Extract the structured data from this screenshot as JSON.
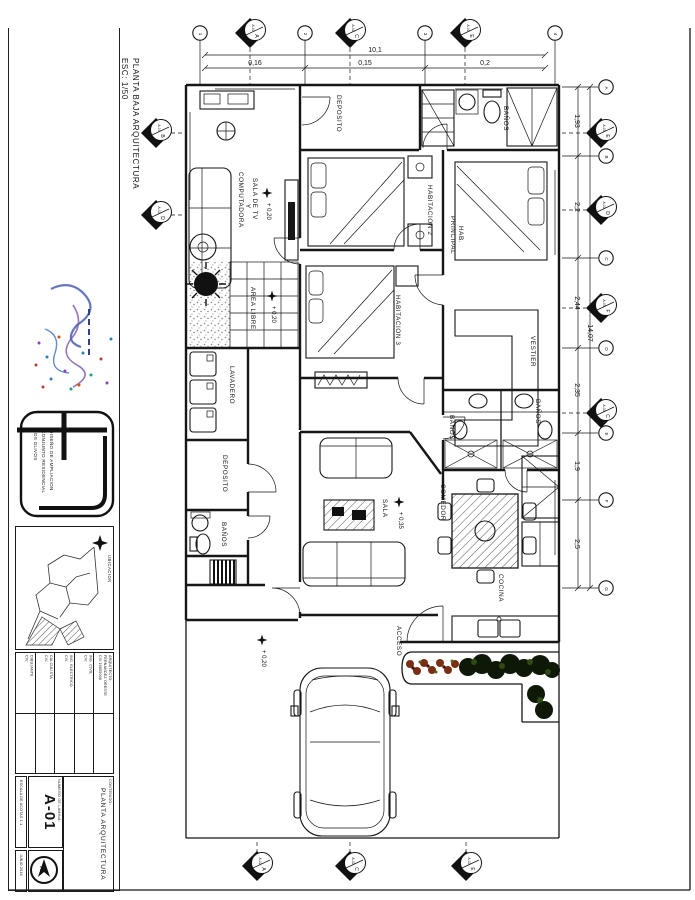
{
  "sheet": {
    "title_vertical": "PLANTA BAJA ARQUITECTURA",
    "scale_note": "ESC: 1/50"
  },
  "branding": {
    "firm_lines": [
      "DISEÑO DE AMPLIACION",
      "CONJUNTO RESIDENCIAL",
      "LOS OLIVOS"
    ]
  },
  "location": {
    "label": "UBICACION"
  },
  "signatures": [
    {
      "role": "DIBUJANTE",
      "name": "",
      "reg": "CIV."
    },
    {
      "role": "CALCULISTA",
      "name": "",
      "reg": "CIV."
    },
    {
      "role": "ING. ELECTRICO",
      "name": "",
      "reg": "CIV."
    },
    {
      "role": "ING. CIVIL",
      "name": "",
      "reg": "CIV."
    },
    {
      "role": "ARQUITECTO:",
      "name": "FERNANDEZ ORESTE",
      "reg": "CIV.19855006"
    }
  ],
  "titleblock": {
    "scale_strip": "ESCALA DE ACOTAS 1:1",
    "date_strip": "JUNIO 2016",
    "sheet_no_label": "NUMERO DE LAMINA:",
    "sheet_no": "A-01",
    "content_label": "CONTENIDO:",
    "content": "PLANTA ARQUITECTURA",
    "north_letter": "N"
  },
  "dims": {
    "top": {
      "overall": "10,1",
      "segments": [
        "0,16",
        "0,15",
        "0,2"
      ]
    },
    "right": {
      "overall": "14,07",
      "segments": [
        "1,93",
        "2,2",
        "2,44",
        "2,35",
        "1,9",
        "2,5"
      ]
    }
  },
  "grid": {
    "top_circles": [
      "1",
      "2",
      "3",
      "4"
    ],
    "right_circles": [
      "A",
      "B",
      "C",
      "D",
      "E",
      "F",
      "G"
    ]
  },
  "markers": {
    "top": [
      {
        "letter": "A",
        "sheet": "A-02"
      },
      {
        "letter": "C",
        "sheet": "A-02"
      },
      {
        "letter": "E",
        "sheet": "A-02"
      }
    ],
    "bottom": [
      {
        "letter": "A",
        "sheet": "A-02"
      },
      {
        "letter": "C",
        "sheet": "A-02"
      },
      {
        "letter": "E",
        "sheet": "A-02"
      }
    ],
    "left": [
      {
        "letter": "B",
        "sheet": "A-01"
      },
      {
        "letter": "D",
        "sheet": "A-01"
      }
    ],
    "right": [
      {
        "letter": "E",
        "sheet": "A-03"
      },
      {
        "letter": "D",
        "sheet": "A-01"
      },
      {
        "letter": "F",
        "sheet": "A-03"
      },
      {
        "letter": "C",
        "sheet": "A-03"
      }
    ]
  },
  "rooms": {
    "deposito_top": "DEPOSITO",
    "banos_top": "BAÑOS",
    "sala_tv_1": "SALA DE TV",
    "sala_tv_2": "Y",
    "sala_tv_3": "COMPUTADORA",
    "habitacion2": "HABITACION 2",
    "hab_principal_1": "HAB.",
    "hab_principal_2": "PRINCIPAL",
    "area_libre": "AREA LIBRE",
    "habitacion3": "HABITACION 3",
    "vestier": "VESTIER",
    "lavadero": "LAVADERO",
    "banos_c1": "BAÑOS",
    "banos_c2": "BAÑOS",
    "deposito_left": "DEPOSITO",
    "banos_left": "BAÑOS",
    "sala": "SALA",
    "comedor": "COMEDOR",
    "cocina": "COCINA",
    "acceso": "ACCESO"
  },
  "levels": {
    "sala_tv": "+ 0,20",
    "area_libre": "+ 0,20",
    "sala": "+ 0,35",
    "acceso": "+ 0,20"
  },
  "colors": {
    "line": "#161616",
    "watermark_blue": "#4a5fb5",
    "watermark_purple": "#7a55a8",
    "plant_dark": "#0d1806",
    "plant_green": "#2d4a12",
    "flower": "#7a2e14"
  }
}
